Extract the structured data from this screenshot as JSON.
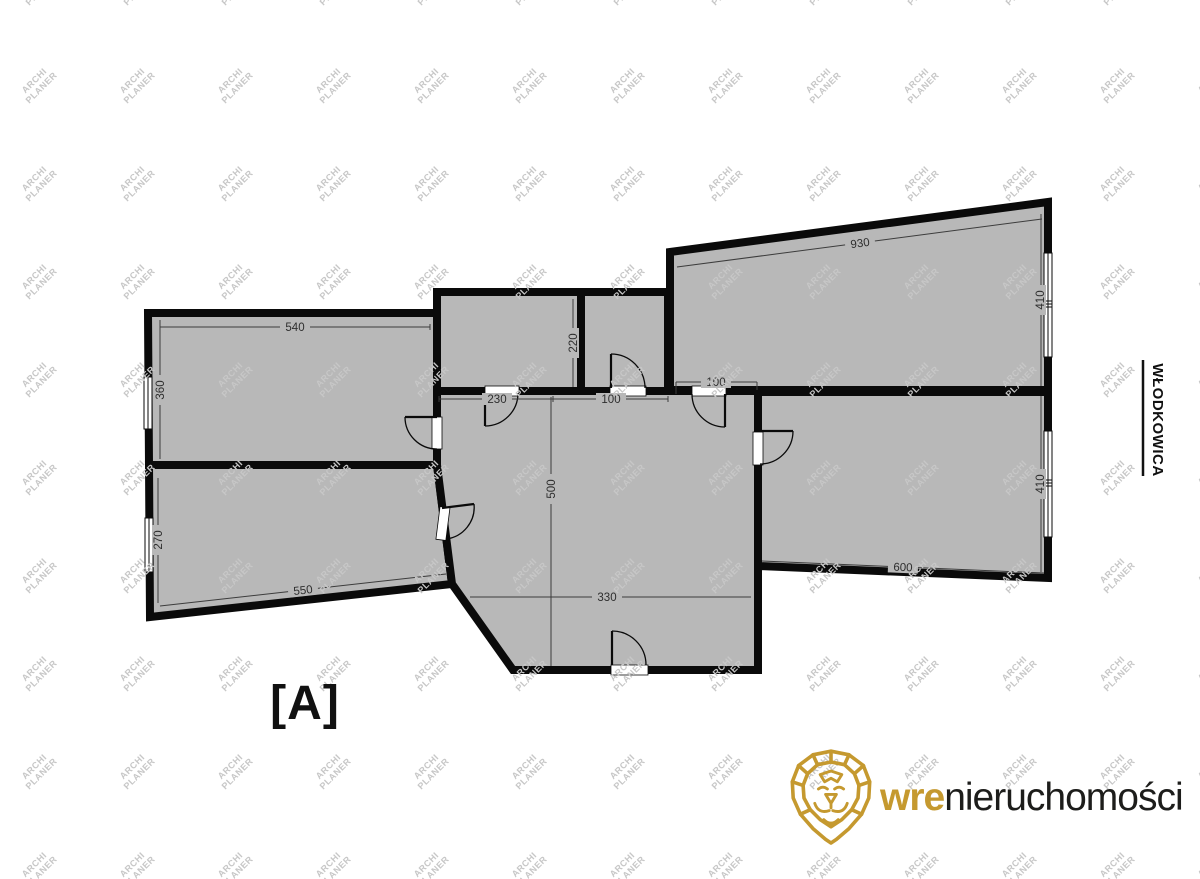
{
  "plan": {
    "variant_label": "[A]",
    "street_label": "WŁODKOWICA",
    "dimensions": {
      "room_top_left_width": "540",
      "room_top_left_height": "360",
      "room_bottom_left_height": "270",
      "room_bottom_left_width": "550",
      "hall_top_left_width": "230",
      "small_room_height": "220",
      "small_room_opening": "100",
      "top_right_door": "100",
      "room_top_right_width": "930",
      "room_top_right_height": "410",
      "room_bottom_right_height": "410",
      "room_bottom_right_width": "600",
      "hallway_height": "500",
      "hallway_width": "330"
    },
    "colors": {
      "wall": "#0a0a0a",
      "room_fill": "#b8b8b8",
      "dimension_line": "#3c3c3c"
    }
  },
  "watermark": {
    "line1": "ARCHI",
    "line2": "PLANER",
    "color": "#c7c7c7"
  },
  "logo": {
    "brand_bold": "wre",
    "brand_rest": "nieruchomości",
    "gold": "#c5992f",
    "dark": "#1d1d1b"
  }
}
